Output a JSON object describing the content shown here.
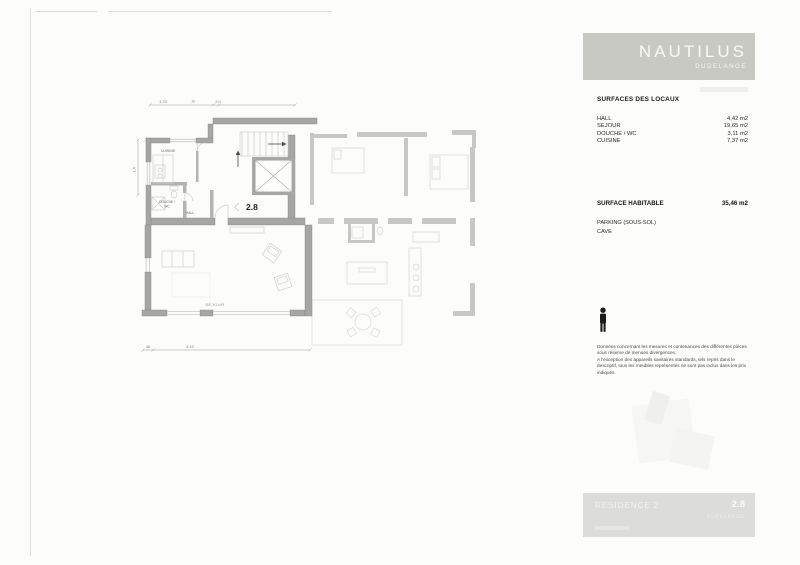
{
  "header": {
    "title": "NAUTILUS",
    "subtitle": "DUDELANGE"
  },
  "surfaces": {
    "heading": "SURFACES DES LOCAUX",
    "rows": [
      {
        "label": "HALL",
        "value": "4,42 m2"
      },
      {
        "label": "SEJOUR",
        "value": "19,65 m2"
      },
      {
        "label": "DOUCHE / WC",
        "value": "3,11 m2"
      },
      {
        "label": "CUISINE",
        "value": "7,37 m2"
      }
    ]
  },
  "habitable": {
    "label": "SURFACE HABITABLE",
    "value": "35,46 m2"
  },
  "annexes": {
    "parking": "PARKING (SOUS-SOL)",
    "cave": "CAVE"
  },
  "disclaimer": {
    "lines": [
      "Données concernant les mesures et contenances des différentes pièces",
      "sous réserve de menues divergences.",
      "A l'exception des appareils sanitaires standards, tels repris dans le",
      "descriptif, tous les meubles représentés ne sont pas inclus dans les prix",
      "indiqués."
    ]
  },
  "footer": {
    "residence": "RESIDENCE 2",
    "unit": "2.8",
    "city": "DUDELANGE"
  },
  "plan": {
    "apartment_label": "2.8",
    "room_labels": {
      "kitchen": "CUISINE",
      "shower_line1": "DOUCHE /",
      "shower_line2": "WC",
      "hall": "HALL",
      "living": "SEJOUR"
    },
    "dimensions": {
      "top_left": "1,70",
      "top_mid": "10",
      "top_right": "2,0",
      "left": "1,4",
      "bottom_small": "40",
      "bottom_large": "4,10"
    }
  }
}
